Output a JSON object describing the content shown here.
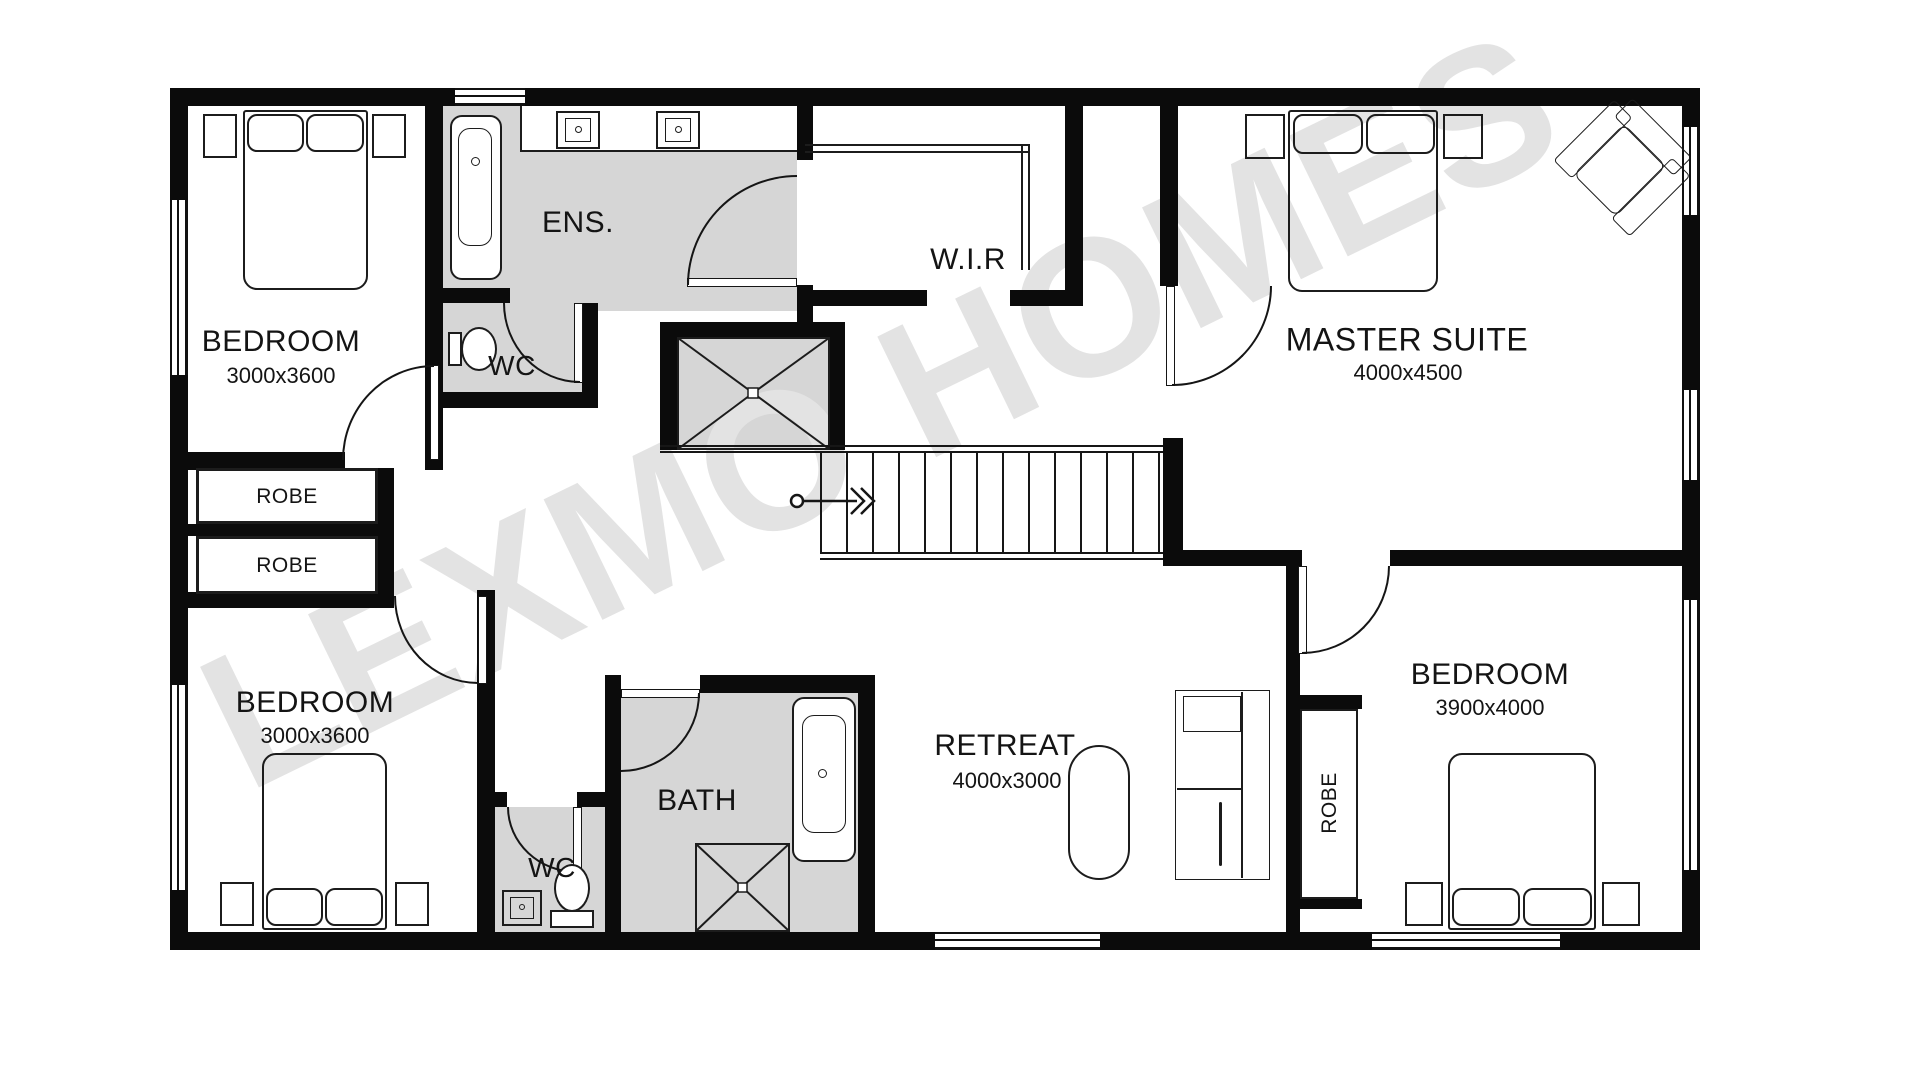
{
  "watermark": "LEXMO HOMES",
  "rooms": {
    "bedroom_top_left": {
      "label": "BEDROOM",
      "dims": "3000x3600"
    },
    "ensuite": {
      "label": "ENS."
    },
    "wc_upper": {
      "label": "WC"
    },
    "wir": {
      "label": "W.I.R"
    },
    "master_suite": {
      "label": "MASTER SUITE",
      "dims": "4000x4500"
    },
    "robe_upper": {
      "label": "ROBE"
    },
    "robe_lower": {
      "label": "ROBE"
    },
    "bedroom_bottom_left": {
      "label": "BEDROOM",
      "dims": "3000x3600"
    },
    "wc_lower": {
      "label": "WC"
    },
    "bath": {
      "label": "BATH"
    },
    "retreat": {
      "label": "RETREAT",
      "dims": "4000x3000"
    },
    "robe_bedroom3": {
      "label": "ROBE"
    },
    "bedroom_bottom_right": {
      "label": "BEDROOM",
      "dims": "3900x4000"
    }
  },
  "colors": {
    "wall": "#0b0b0b",
    "wet_area": "#d6d6d6",
    "watermark": "#e3e3e3"
  }
}
